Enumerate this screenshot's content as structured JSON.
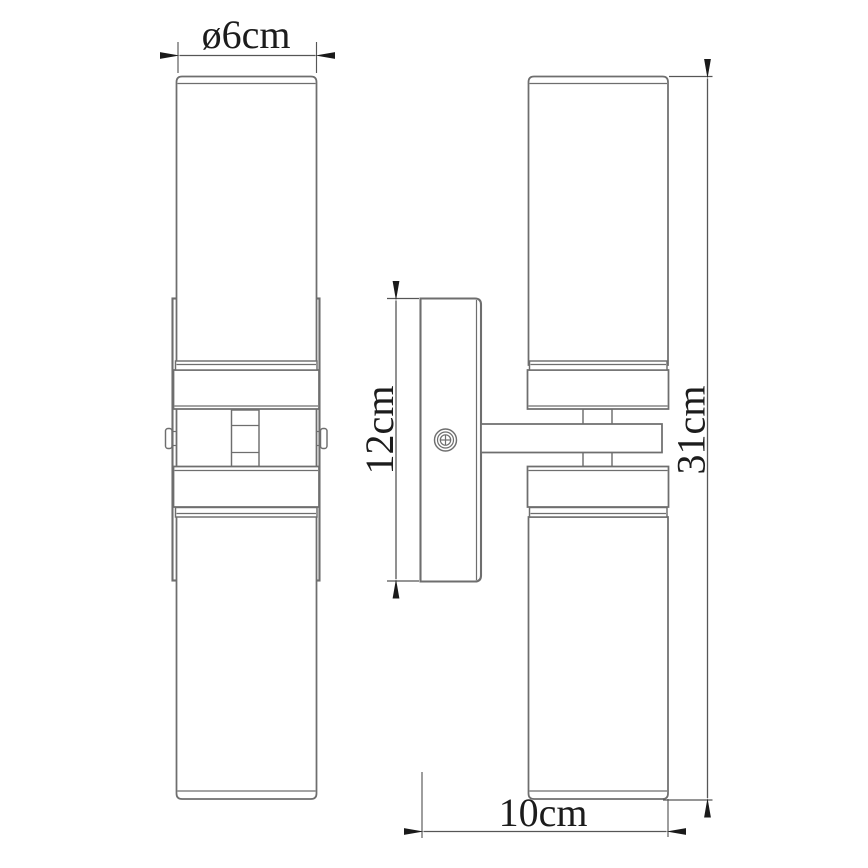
{
  "drawing": {
    "dimensions": {
      "diameter": "ø6cm",
      "bracket_height": "12cm",
      "total_height": "31cm",
      "depth": "10cm"
    },
    "colors": {
      "background": "#ffffff",
      "object_line": "#6e6e6e",
      "dimension_line": "#565656",
      "arrow": "#1a1a1a",
      "text": "#1c1c1c"
    }
  }
}
